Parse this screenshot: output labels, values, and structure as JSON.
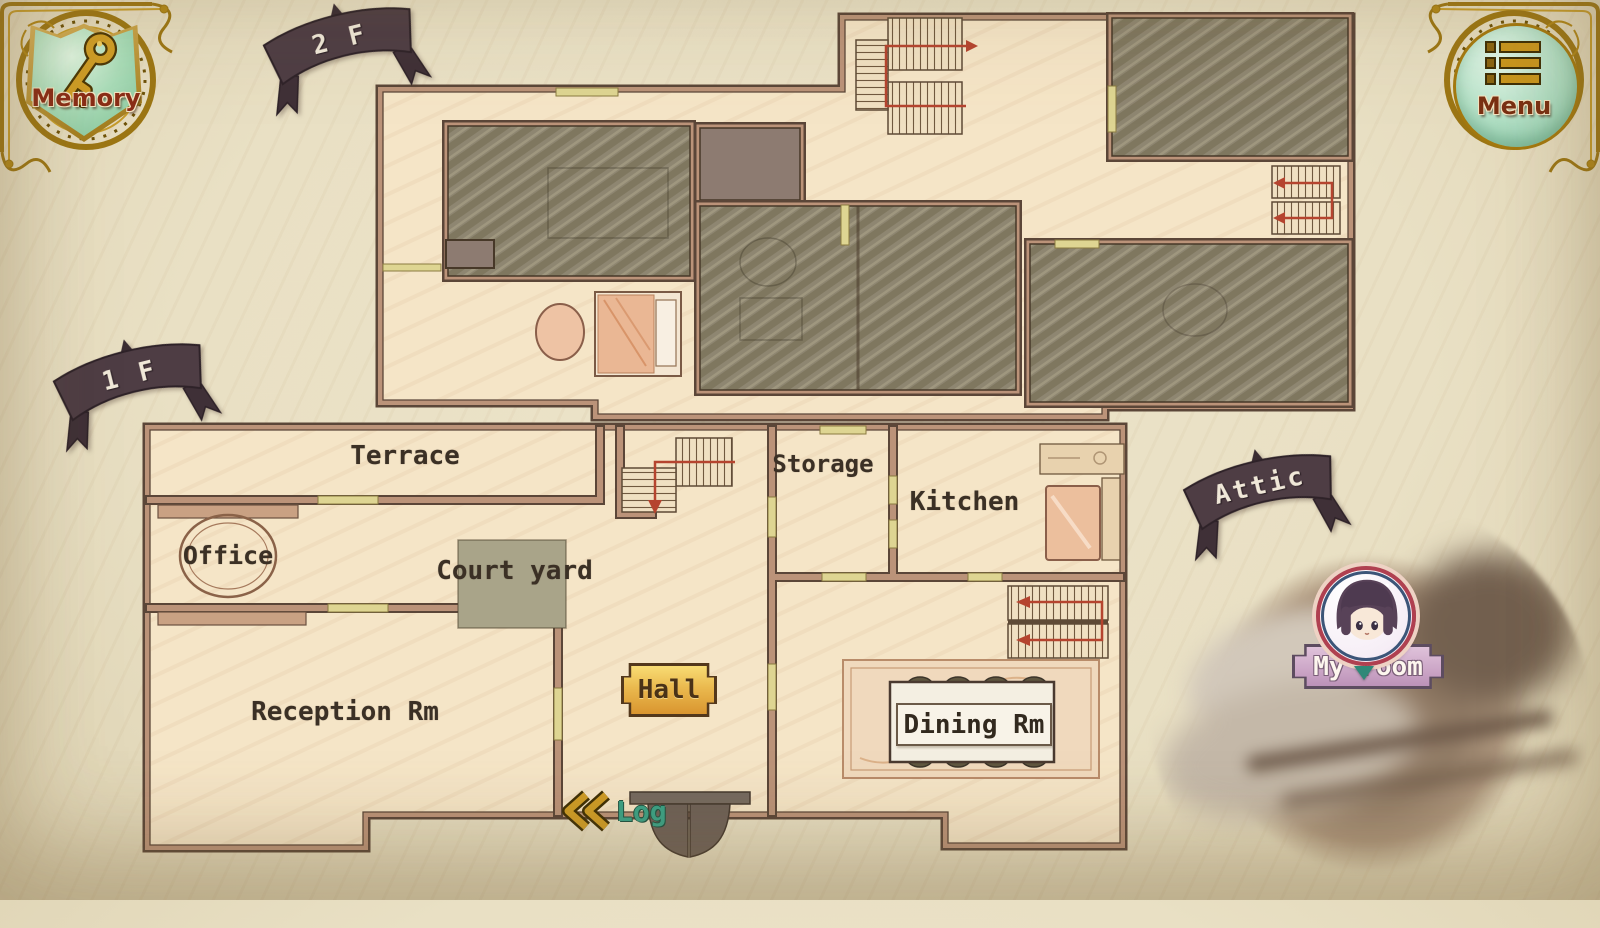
{
  "buttons": {
    "memory": "Memory",
    "menu": "Menu",
    "log": "Log"
  },
  "banners": {
    "floor2": "2 F",
    "floor1": "1 F",
    "attic": "Attic"
  },
  "rooms": {
    "terrace": "Terrace",
    "office": "Office",
    "courtyard": "Court yard",
    "reception": "Reception Rm",
    "hall": "Hall",
    "storage": "Storage",
    "kitchen": "Kitchen",
    "dining": "Dining Rm",
    "my_room": "My room"
  },
  "icons": {
    "memory": "key-icon",
    "menu": "menu-list-icon",
    "log": "double-chevron-left-icon",
    "my_room_pin": "character-avatar"
  },
  "colors": {
    "background": "#e9e0c6",
    "wall": "#bb9379",
    "wall_outline": "#5b4638",
    "floor": "#f5e5c7",
    "hatched_room": "#8e8671",
    "banner": "#4e3d44",
    "gold": "#c9961e",
    "hall_plaque": "#e8ae42",
    "log_text": "#3aa287",
    "my_room_plaque": "#cfaecb",
    "shield_green": "#a6d8b4",
    "stairs_path_red": "#b5442f"
  }
}
